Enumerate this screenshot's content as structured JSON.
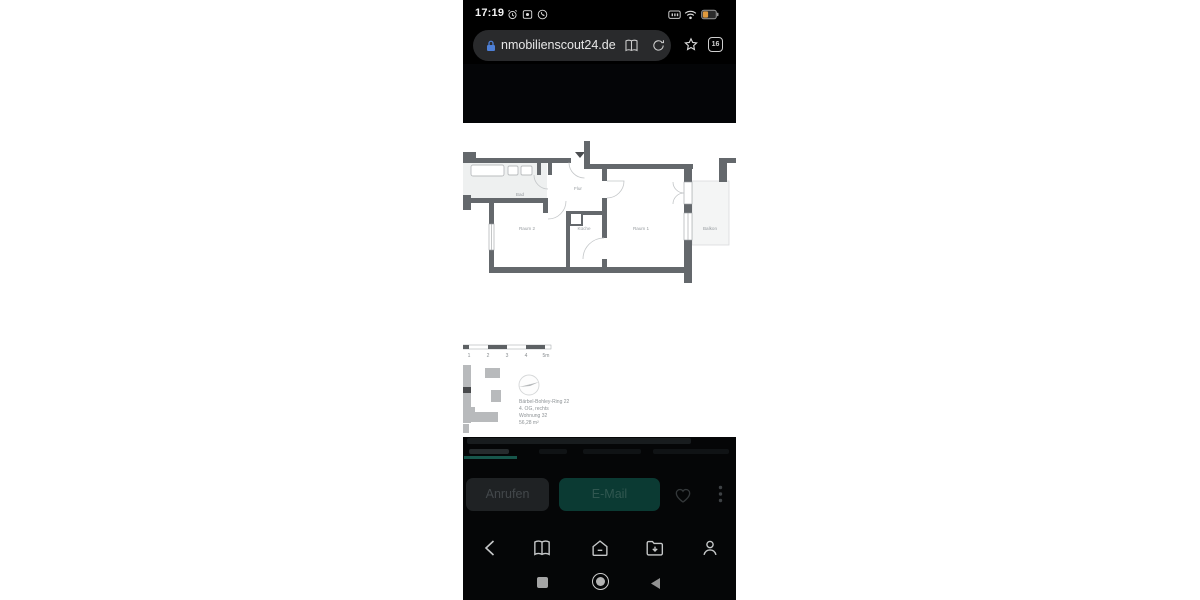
{
  "status_bar": {
    "time": "17:19"
  },
  "browser_bar": {
    "url": "nmobilienscout24.de",
    "tab_count": "16"
  },
  "archive_banner": {
    "title": "Angebot liegt im Archiv",
    "subtitle": "Dieses Angebot wurde vom Anbieter aus"
  },
  "floorplan": {
    "room_labels": {
      "bad": "Bad",
      "flur": "Flur",
      "raum2": "Raum 2",
      "kueche": "Küche",
      "raum1": "Raum 1",
      "balkon": "Balkon"
    },
    "scale_labels": [
      "1",
      "2",
      "3",
      "4",
      "5m"
    ],
    "info_lines": [
      "Bärbel-Bohley-Ring 22",
      "4. OG, rechts",
      "Wohnung 32",
      "56,28 m²"
    ]
  },
  "contact_actions": {
    "call": "Anrufen",
    "email": "E-Mail"
  },
  "colors": {
    "accent_teal": "#0b3a33",
    "tab_underline": "#17564b",
    "lock_blue": "#4d7fd6",
    "battery_orange": "#e09a3e",
    "wall_gray": "#64686c"
  }
}
